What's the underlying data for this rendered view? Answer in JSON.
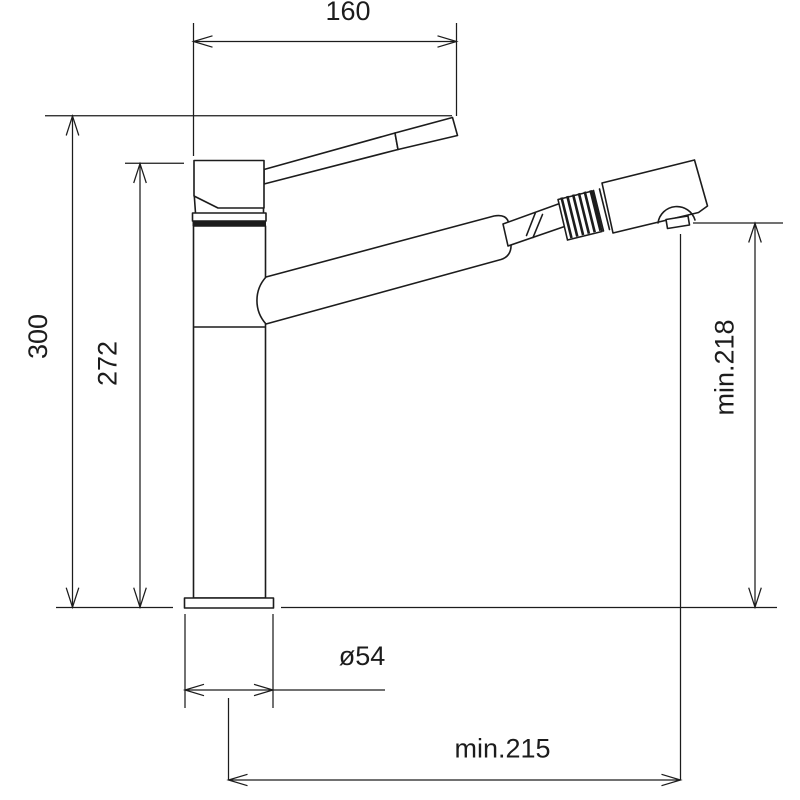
{
  "drawing": {
    "description": "Technical dimension drawing of a single-lever kitchen mixer tap with pull-out spray head",
    "labels": {
      "spout_width": "160",
      "total_height": "300",
      "body_height": "272",
      "outlet_height": "min.218",
      "base_diameter": "ø54",
      "reach": "min.215"
    },
    "colors": {
      "line": "#1c1c1c",
      "background": "#ffffff"
    }
  }
}
